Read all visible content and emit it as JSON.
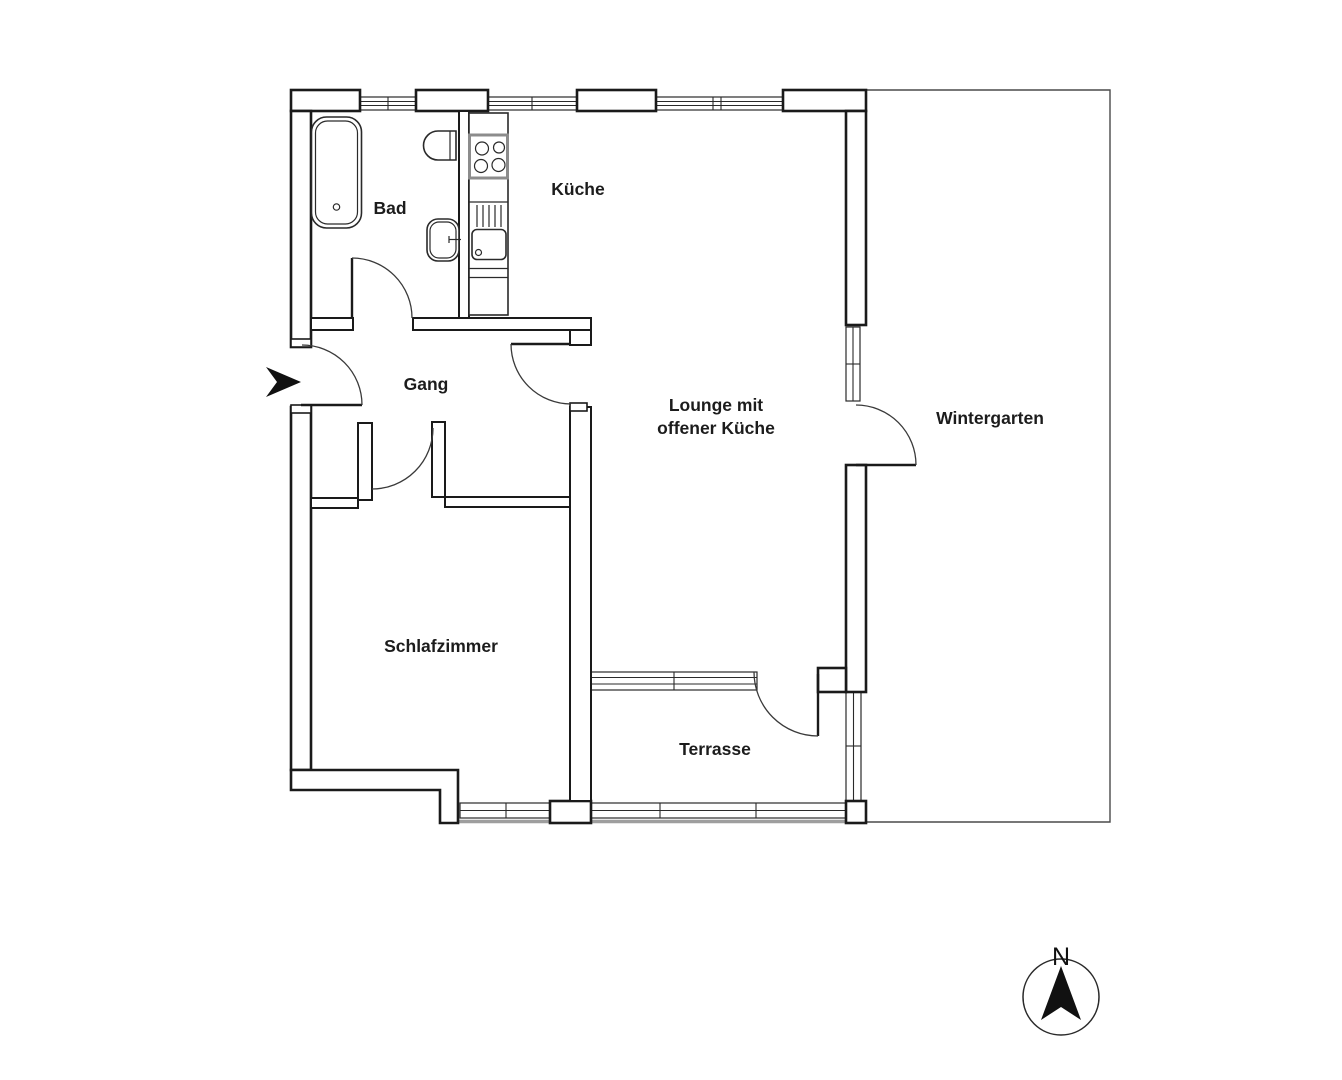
{
  "floorplan": {
    "rooms": {
      "bad": {
        "label": "Bad"
      },
      "kueche": {
        "label": "Küche"
      },
      "gang": {
        "label": "Gang"
      },
      "lounge": {
        "label_line1": "Lounge mit",
        "label_line2": "offener Küche"
      },
      "wintergarten": {
        "label": "Wintergarten"
      },
      "schlafzimmer": {
        "label": "Schlafzimmer"
      },
      "terrasse": {
        "label": "Terrasse"
      }
    },
    "compass": {
      "north_label": "N"
    },
    "fixtures": [
      "bathtub",
      "toilet",
      "washbasin",
      "stove",
      "kitchen-sink",
      "kitchen-counter"
    ],
    "colors": {
      "wall": "#1a1a1a",
      "background": "#ffffff",
      "window_sill": "#9e9e9e",
      "stove_border": "#8c8c8c"
    }
  }
}
